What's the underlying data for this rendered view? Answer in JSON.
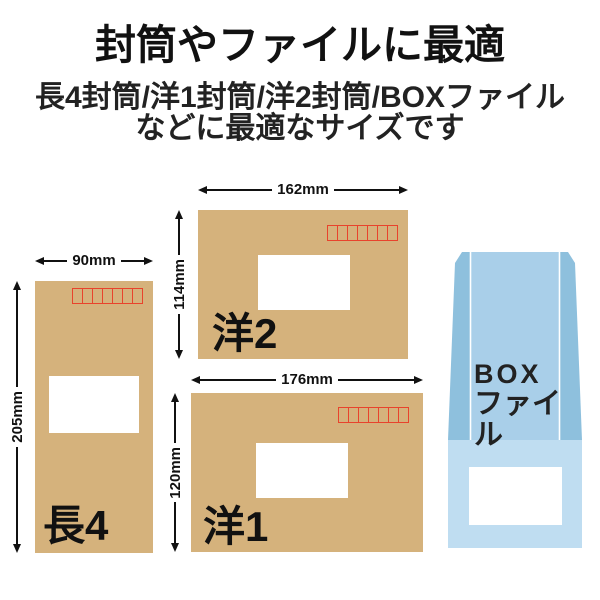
{
  "header": {
    "title": "封筒やファイルに最適",
    "subtitle_line1": "長4封筒/洋1封筒/洋2封筒/BOXファイル",
    "subtitle_line2": "などに最適なサイズです"
  },
  "envelopes": [
    {
      "name": "長4",
      "width_label": "90mm",
      "height_label": "205mm"
    },
    {
      "name": "洋2",
      "width_label": "162mm",
      "height_label": "114mm"
    },
    {
      "name": "洋1",
      "width_label": "176mm",
      "height_label": "120mm"
    }
  ],
  "boxfile": {
    "label_line1": "BOX",
    "label_line2": "ファイル"
  },
  "colors": {
    "envelope_kraft": "#d5b27c",
    "postal_box_red": "#e8432c",
    "window_white": "#ffffff",
    "boxfile_center": "#a9cfe9",
    "boxfile_side": "#8ec0dd",
    "boxfile_band": "#bfddf1",
    "dimension_line": "#111111",
    "text": "#1a1a1a"
  }
}
